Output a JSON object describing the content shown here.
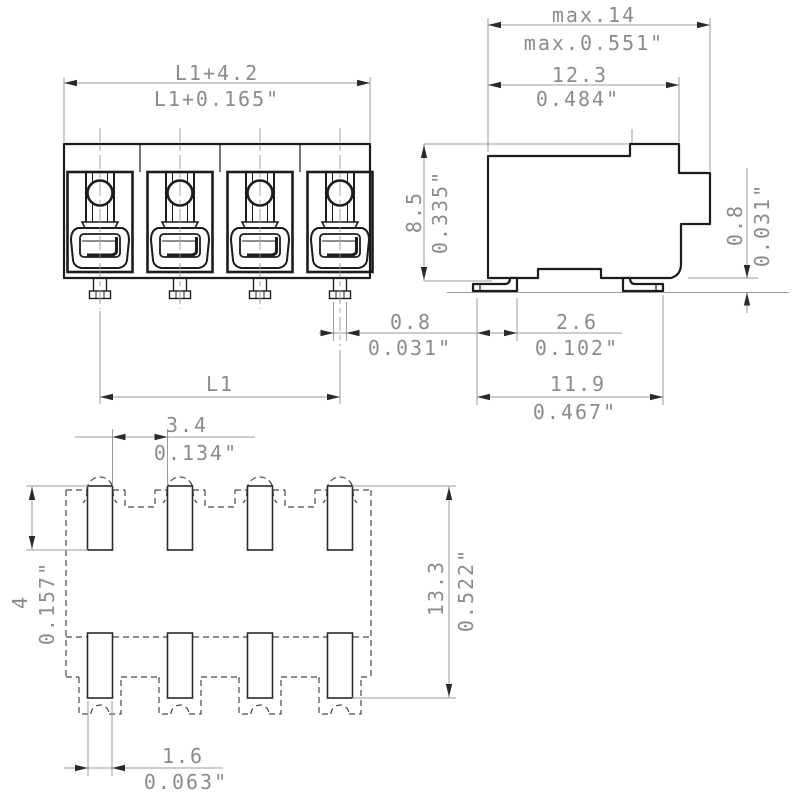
{
  "drawing": {
    "background": "#ffffff",
    "line_color": "#1c1c1c",
    "dim_line_color": "#9b9b9b",
    "arrow_color": "#2a2a2a",
    "dash_color": "#4a4a4a",
    "centerline_color": "#9a9a9a",
    "text_color": "#8b8b8b",
    "views": {
      "front": {
        "label": "front-view",
        "poles": 4
      },
      "side": {
        "label": "side-view"
      },
      "footprint": {
        "label": "footprint-view",
        "pads_per_row": 4,
        "rows": 2
      }
    },
    "dimensions": {
      "front_overall": {
        "metric": "L1+4.2",
        "inch": "L1+0.165\""
      },
      "front_pitch": {
        "metric": "L1"
      },
      "front_pin_width": {
        "metric": "0.8",
        "inch": "0.031\""
      },
      "side_max_depth": {
        "metric": "max.14",
        "inch": "max.0.551\""
      },
      "side_body_depth": {
        "metric": "12.3",
        "inch": "0.484\""
      },
      "side_height": {
        "metric": "8.5",
        "inch": "0.335\""
      },
      "side_standoff": {
        "metric": "0.8",
        "inch": "0.031\""
      },
      "side_foot_width": {
        "metric": "2.6",
        "inch": "0.102\""
      },
      "side_foot_span": {
        "metric": "11.9",
        "inch": "0.467\""
      },
      "fp_pad_gap": {
        "metric": "3.4",
        "inch": "0.134\""
      },
      "fp_pad_height": {
        "metric": "4",
        "inch": "0.157\""
      },
      "fp_total_height": {
        "metric": "13.3",
        "inch": "0.522\""
      },
      "fp_pad_width": {
        "metric": "1.6",
        "inch": "0.063\""
      }
    }
  }
}
